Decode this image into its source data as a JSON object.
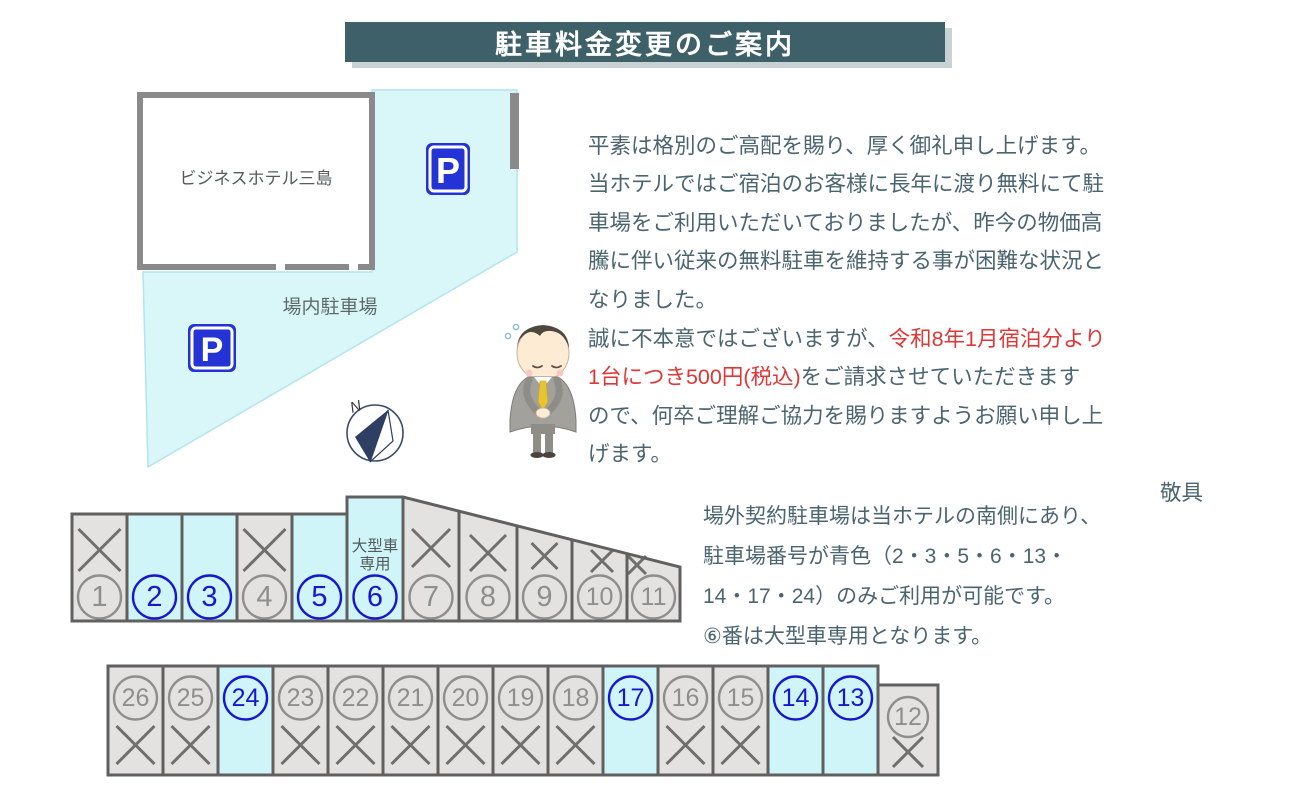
{
  "title": {
    "text": "駐車料金変更のご案内",
    "bg": "#3e6169",
    "shadow": "#c8d2d3"
  },
  "map": {
    "hotel_label": "ビジネスホテル三島",
    "lot_label": "場内駐車場",
    "compass_label": "N",
    "sign_letter": "P",
    "colors": {
      "area": "#d9f6f9",
      "area_edge": "#b4e4ec",
      "wall": "#8a8a8a",
      "sign_blue": "#2433d6"
    }
  },
  "notice": {
    "para1": "平素は格別のご高配を賜り、厚く御礼申し上げます。\n当ホテルではご宿泊のお客様に長年に渡り無料にて駐\n車場をご利用いただいておりましたが、昨今の物価高\n騰に伴い従来の無料駐車を維持する事が困難な状況と\nなりました。",
    "para2_pre": "誠に不本意ではございますが、",
    "para2_red": "令和8年1月宿泊分より\n1台につき500円(税込)",
    "para2_post": "をご請求させていただきます\nので、何卒ご理解ご協力を賜りますようお願い申し上\nげます。",
    "closing": "敬具",
    "red_color": "#e03636"
  },
  "side_note": "場外契約駐車場は当ホテルの南側にあり、\n駐車場番号が青色（2・3・5・6・13・\n14・17・24）のみご利用が可能です。\n⑥番は大型車専用となります。",
  "parking": {
    "large_label1": "大型車",
    "large_label2": "専用",
    "colors": {
      "closed_fill": "#e3e2e0",
      "open_fill": "#d0f5f9",
      "border": "#606060",
      "x_mark": "#6f6f6f",
      "gray_num": "#8e8e8e",
      "blue_num": "#1717cf",
      "label": "#525b5b"
    },
    "top_row": [
      {
        "num": "1",
        "open": false
      },
      {
        "num": "2",
        "open": true
      },
      {
        "num": "3",
        "open": true
      },
      {
        "num": "4",
        "open": false
      },
      {
        "num": "5",
        "open": true
      },
      {
        "num": "6",
        "open": true,
        "large": true
      },
      {
        "num": "7",
        "open": false
      },
      {
        "num": "8",
        "open": false
      },
      {
        "num": "9",
        "open": false
      },
      {
        "num": "10",
        "open": false
      },
      {
        "num": "11",
        "open": false
      }
    ],
    "bottom_row": [
      {
        "num": "26",
        "open": false
      },
      {
        "num": "25",
        "open": false
      },
      {
        "num": "24",
        "open": true
      },
      {
        "num": "23",
        "open": false
      },
      {
        "num": "22",
        "open": false
      },
      {
        "num": "21",
        "open": false
      },
      {
        "num": "20",
        "open": false
      },
      {
        "num": "19",
        "open": false
      },
      {
        "num": "18",
        "open": false
      },
      {
        "num": "17",
        "open": true
      },
      {
        "num": "16",
        "open": false
      },
      {
        "num": "15",
        "open": false
      },
      {
        "num": "14",
        "open": true
      },
      {
        "num": "13",
        "open": true
      },
      {
        "num": "12",
        "open": false,
        "offset": true
      }
    ]
  }
}
